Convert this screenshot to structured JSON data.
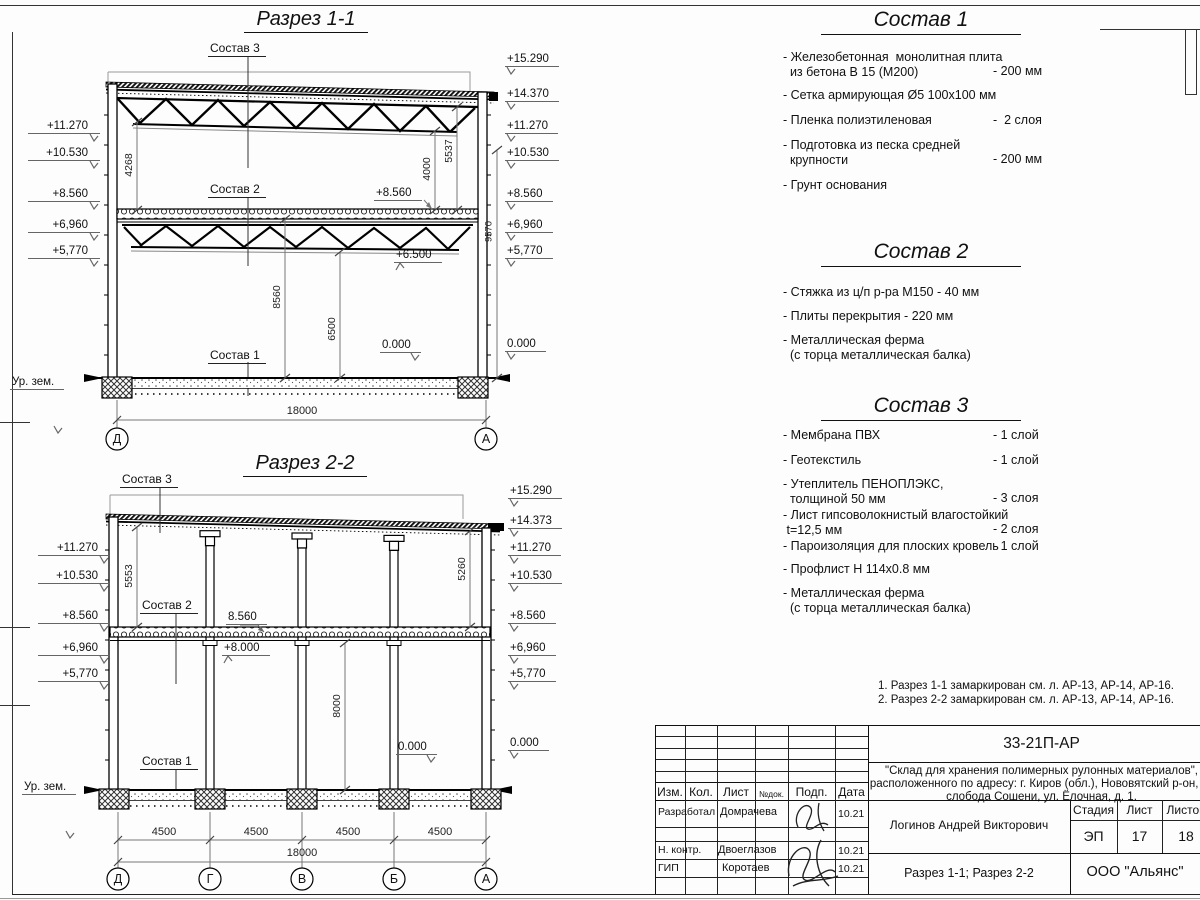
{
  "section1": {
    "title": "Разрез 1-1",
    "callouts": {
      "sostav3": "Состав 3",
      "sostav2": "Состав 2",
      "sostav1": "Состав 1"
    },
    "ground_label": "Ур. зем.",
    "marks_left": [
      "+11.270",
      "+10.530",
      "+8.560",
      "+6,960",
      "+5,770"
    ],
    "marks_right": [
      "+15.290",
      "+14.370",
      "+11.270",
      "+10.530",
      "+8.560",
      "+6,960",
      "+5,770",
      "0.000"
    ],
    "mark_slab": "+8.560",
    "mark_truss_bottom": "+6.500",
    "mark_floor": "0.000",
    "dim_left": "4268",
    "dim_right_a": "4000",
    "dim_right_b": "5537",
    "dim_outer": "9570",
    "dim_hall_a": "8560",
    "dim_hall_b": "6500",
    "dim_total": "18000",
    "axes": [
      "Д",
      "А"
    ]
  },
  "section2": {
    "title": "Разрез 2-2",
    "callouts": {
      "sostav3": "Состав 3",
      "sostav2": "Состав 2",
      "sostav1": "Состав 1"
    },
    "ground_label": "Ур. зем.",
    "marks_left": [
      "+11.270",
      "+10.530",
      "+8.560",
      "+6,960",
      "+5,770"
    ],
    "marks_right": [
      "+15.290",
      "+14.373",
      "+11.270",
      "+10.530",
      "+8.560",
      "+6,960",
      "+5,770",
      "0.000"
    ],
    "mark_slab": "8.560",
    "mark_soffit": "+8.000",
    "mark_floor": "0.000",
    "dim_left": "5553",
    "dim_right": "5260",
    "dim_hall": "8000",
    "dim_spans": [
      "4500",
      "4500",
      "4500",
      "4500"
    ],
    "dim_total": "18000",
    "axes": [
      "Д",
      "Г",
      "В",
      "Б",
      "А"
    ]
  },
  "specs": [
    {
      "title": "Состав 1",
      "items": [
        {
          "name": "- Железобетонная  монолитная плита\n  из бетона В 15 (М200)",
          "value": "- 200 мм"
        },
        {
          "name": "- Сетка армирующая Ø5 100х100 мм",
          "value": ""
        },
        {
          "name": "- Пленка полиэтиленовая",
          "value": "-  2 слоя"
        },
        {
          "name": "- Подготовка из песка средней\n  крупности",
          "value": "- 200 мм"
        },
        {
          "name": "- Грунт основания",
          "value": ""
        }
      ]
    },
    {
      "title": "Состав 2",
      "items": [
        {
          "name": "- Стяжка из ц/п р-ра М150 - 40 мм",
          "value": ""
        },
        {
          "name": "- Плиты перекрытия - 220 мм",
          "value": ""
        },
        {
          "name": "- Металлическая ферма\n  (с торца металлическая балка)",
          "value": ""
        }
      ]
    },
    {
      "title": "Состав 3",
      "items": [
        {
          "name": "- Мембрана ПВХ",
          "value": "- 1 слой"
        },
        {
          "name": "- Геотекстиль",
          "value": "- 1 слой"
        },
        {
          "name": "- Утеплитель ПЕНОПЛЭКС,\n  толщиной 50 мм",
          "value": "- 3 слоя"
        },
        {
          "name": "- Лист гипсоволокнистый влагостойкий\n t=12,5 мм",
          "value": "- 2 слоя"
        },
        {
          "name": "- Пароизоляция для плоских кровель",
          "value": "- 1 слой"
        },
        {
          "name": "- Профлист Н 114х0.8 мм",
          "value": ""
        },
        {
          "name": "- Металлическая ферма\n  (с торца металлическая балка)",
          "value": ""
        }
      ]
    }
  ],
  "notes": [
    "1. Разрез 1-1 замаркирован см. л. АР-13, АР-14, АР-16.",
    "2. Разрез 2-2 замаркирован см. л. АР-13, АР-14, АР-16."
  ],
  "title_block": {
    "doc_code": "33-21П-АР",
    "project_lines": [
      "\"Склад для хранения полимерных рулонных материалов\",",
      "расположенного по адресу: г. Киров (обл.), Нововятский р-он, те",
      "слобода Сошени, ул. Ёлочная, д. 1."
    ],
    "header_cols": [
      "Изм.",
      "Кол.",
      "Лист",
      "№док.",
      "Подп.",
      "Дата"
    ],
    "rows": [
      {
        "role": "Разработал",
        "name": "Домрачева",
        "date": "10.21"
      },
      {
        "role": "Н. контр.",
        "name": "Двоеглазов",
        "date": "10.21"
      },
      {
        "role": "ГИП",
        "name": "Коротаев",
        "date": "10.21"
      }
    ],
    "chief": "Логинов Андрей Викторович",
    "stage_label": "Стадия",
    "sheet_label": "Лист",
    "sheets_label": "Листов",
    "stage": "ЭП",
    "sheet_no": "17",
    "sheets_total": "18",
    "sheet_title": "Разрез 1-1; Разрез 2-2",
    "company": "ООО \"Альянс\""
  }
}
